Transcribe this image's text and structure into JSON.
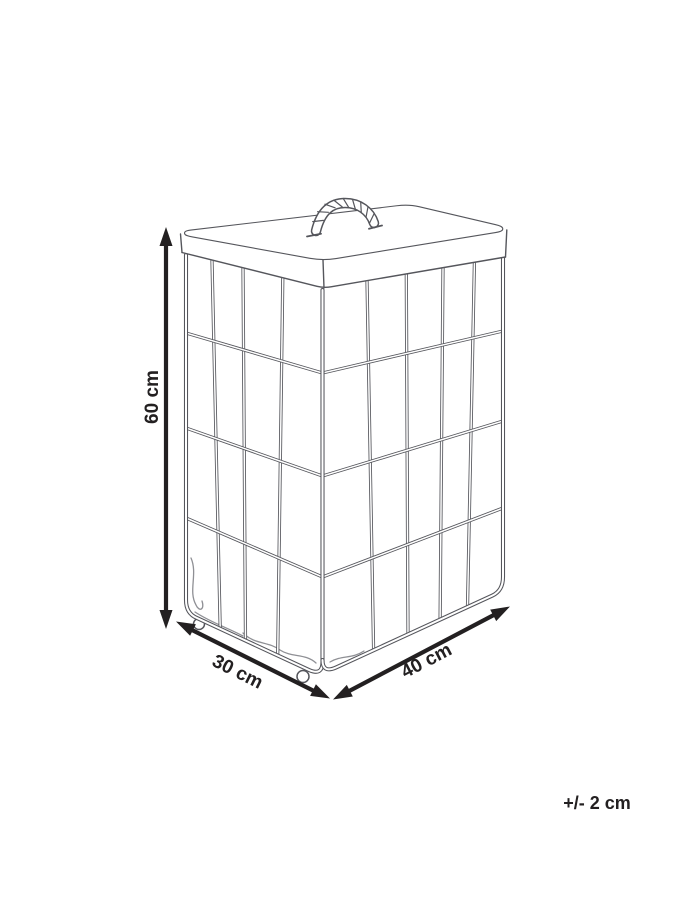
{
  "diagram": {
    "type": "product-dimension-drawing",
    "subject": "Laundry basket: wire cage with fabric liner, fabric lid with rope handle, caster wheels",
    "dimensions": {
      "height": {
        "label": "60 cm"
      },
      "depth": {
        "label": "30 cm"
      },
      "width": {
        "label": "40 cm"
      }
    },
    "tolerance": {
      "label": "+/- 2 cm"
    },
    "colors": {
      "background": "#ffffff",
      "illustration_line": "#55565c",
      "dimension_line": "#232021",
      "label_text": "#232021"
    }
  }
}
